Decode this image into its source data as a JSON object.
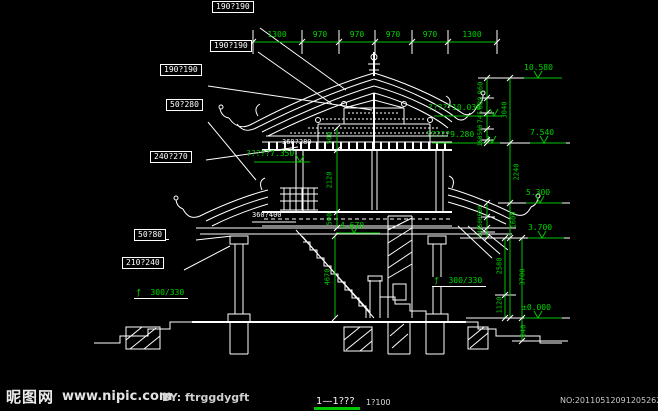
{
  "colors": {
    "background": "#000000",
    "linework": "#ffffff",
    "dimension_green": "#00d400"
  },
  "footer": {
    "site_name": "昵图网",
    "site_url": "www.nipic.com",
    "byline": "BY: ftrggdygft",
    "serial": "NO:20110512091205262000"
  },
  "title_block": {
    "section_title": "1—1???",
    "scale": "1?100"
  },
  "top_dimensions": {
    "values": [
      "1300",
      "970",
      "970",
      "970",
      "970",
      "1300"
    ]
  },
  "label_stacks": {
    "stack1": {
      "rows": [
        "ƒ  240",
        "50?170",
        "190?190"
      ]
    },
    "stack2": {
      "rows": [
        "ƒ  220",
        "50?190",
        "190?190"
      ]
    },
    "stack3": {
      "rows": [
        "ƒ  220",
        "50?220",
        "190?190"
      ]
    },
    "stack4": {
      "rows": [
        "ƒ  220",
        "50?280"
      ]
    },
    "stack5": {
      "rows": [
        "350?180",
        "240?270"
      ]
    },
    "stack6": {
      "rows": [
        "ƒ  240",
        "50?80"
      ]
    },
    "stack7": {
      "rows": [
        "300?140",
        "210?240"
      ]
    },
    "left_column_size": "ƒ  300/330",
    "right_column_size": "ƒ  300/330"
  },
  "member_labels": {
    "eave_beam": "360?280",
    "floor_beam": "360?400"
  },
  "elevation_marks": {
    "ridge": "10.580",
    "mid_upper": "?????10.030",
    "mid_lower": "?????9.280",
    "upper_eave": "7.540",
    "upper_floor": "?????7.350",
    "balcony": "5.300",
    "lower_eave": "3.700",
    "stair_top": "4.670",
    "ground": "±0.000"
  },
  "vertical_dimensions": {
    "roof_segments": [
      "960",
      "680",
      "745",
      "500",
      "160"
    ],
    "roof_total": "3040",
    "upper_story": "2240",
    "mid_segments": [
      "680",
      "500",
      "140"
    ],
    "mid_total": "1600",
    "lower_inner": [
      "2580",
      "1120"
    ],
    "lower_total": "3700",
    "footing": "640",
    "center_chain": [
      "500",
      "2120",
      "500"
    ],
    "stair_height": "4670"
  }
}
